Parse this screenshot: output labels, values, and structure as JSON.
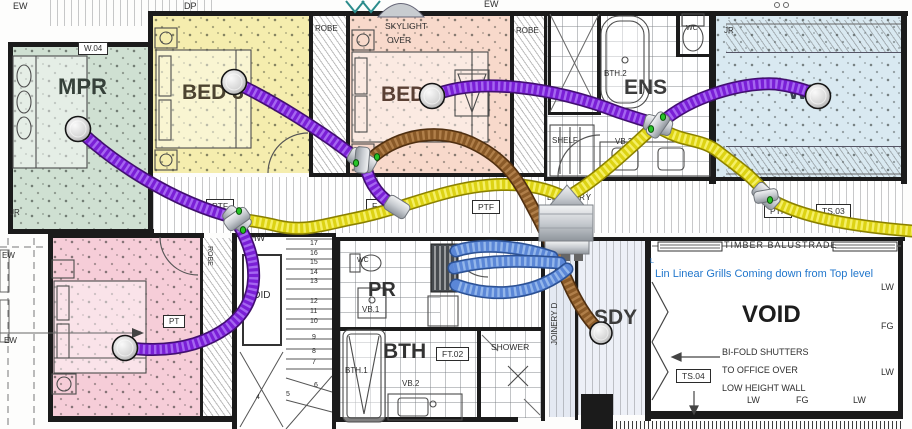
{
  "colors": {
    "purple_core": "#7a1fd6",
    "purple_dark": "#41106e",
    "purple_light": "#a566f0",
    "yellow_core": "#ddd314",
    "yellow_dark": "#8a8000",
    "yellow_light": "#f5ef66",
    "brown_core": "#8a5a28",
    "brown_dark": "#4e2e10",
    "brown_light": "#b07f4a",
    "blue_core": "#5b87d7",
    "blue_dark": "#2c5193",
    "blue_light": "#93b6ea",
    "note_blue": "#2277cc",
    "room_mpr": "#cfe0d2",
    "room_bed3": "#f5edae",
    "room_bed2": "#f8d9cb",
    "room_wir": "#d9e9f1",
    "room_bed4": "#f6cdd8",
    "joinery_floor": "#e4e9f2",
    "sdy_floor": "#edf0f7"
  },
  "note": {
    "text": "Lin Linear Grills Coming down from Top level"
  },
  "labels": [
    {
      "id": "ew-top-left",
      "t": "EW",
      "x": 13,
      "y": 2,
      "s": 9
    },
    {
      "id": "dp-top",
      "t": "DP",
      "x": 184,
      "y": 2,
      "s": 9
    },
    {
      "id": "ew-top-mid",
      "t": "EW",
      "x": 484,
      "y": 0,
      "s": 9
    },
    {
      "id": "w04",
      "t": "W.04",
      "x": 78,
      "y": 42,
      "s": 8,
      "box": true
    },
    {
      "id": "room-mpr",
      "t": "MPR",
      "x": 58,
      "y": 76,
      "s": 22,
      "w": "bold",
      "c": "#36413a"
    },
    {
      "id": "room-bed3",
      "t": "BED 3",
      "x": 182,
      "y": 82,
      "s": 21,
      "w": "bold",
      "c": "#4c4330"
    },
    {
      "id": "room-bed2",
      "t": "BED",
      "x": 381,
      "y": 84,
      "s": 21,
      "w": "bold",
      "c": "#5a4034"
    },
    {
      "id": "room-ens",
      "t": "ENS",
      "x": 624,
      "y": 77,
      "s": 21,
      "w": "bold",
      "c": "#3c3c3c"
    },
    {
      "id": "room-wir",
      "t": "WIR",
      "x": 788,
      "y": 82,
      "s": 21,
      "w": "bold",
      "c": "#3a4450"
    },
    {
      "id": "robe-left",
      "t": "ROBE",
      "x": 315,
      "y": 25,
      "s": 8
    },
    {
      "id": "skylight-line1",
      "t": "SKYLIGHT",
      "x": 385,
      "y": 22,
      "s": 8.5
    },
    {
      "id": "skylight-line2",
      "t": "OVER",
      "x": 387,
      "y": 36,
      "s": 8.5
    },
    {
      "id": "robe-right",
      "t": "ROBE",
      "x": 516,
      "y": 27,
      "s": 8
    },
    {
      "id": "bth2",
      "t": "BTH.2",
      "x": 604,
      "y": 70,
      "s": 8
    },
    {
      "id": "wc-ens",
      "t": "WC",
      "x": 686,
      "y": 25,
      "s": 7
    },
    {
      "id": "jr-wir-top",
      "t": "JR",
      "x": 724,
      "y": 27,
      "s": 8
    },
    {
      "id": "jr-wir-bottom",
      "t": "JR",
      "x": 724,
      "y": 155,
      "s": 8
    },
    {
      "id": "shelf",
      "t": "SHELF",
      "x": 552,
      "y": 137,
      "s": 8
    },
    {
      "id": "vb2-ens",
      "t": "VB.2",
      "x": 615,
      "y": 138,
      "s": 8
    },
    {
      "id": "jr-mpr",
      "t": "JR",
      "x": 10,
      "y": 209,
      "s": 8
    },
    {
      "id": "ew-left-upper",
      "t": "EW",
      "x": 2,
      "y": 252,
      "s": 8
    },
    {
      "id": "ew-left-lower",
      "t": "EW",
      "x": 4,
      "y": 337,
      "s": 8
    },
    {
      "id": "laundry",
      "t": "LAUNDRY",
      "x": 547,
      "y": 194,
      "s": 8,
      "ls": 1
    },
    {
      "id": "ptf-1",
      "t": "PTF",
      "x": 206,
      "y": 199,
      "s": 8.5,
      "box": true
    },
    {
      "id": "ft-1",
      "t": "F",
      "x": 366,
      "y": 199,
      "s": 8.5,
      "box": true
    },
    {
      "id": "ptf-2",
      "t": "PTF",
      "x": 472,
      "y": 200,
      "s": 8.5,
      "box": true
    },
    {
      "id": "ptf-3",
      "t": "PTF",
      "x": 764,
      "y": 204,
      "s": 8.5,
      "box": true
    },
    {
      "id": "ts03",
      "t": "TS.03",
      "x": 816,
      "y": 204,
      "s": 8.5,
      "box": true
    },
    {
      "id": "lhw",
      "t": "LHW",
      "x": 245,
      "y": 234,
      "s": 9
    },
    {
      "id": "void-stair",
      "t": "VOID",
      "x": 246,
      "y": 291,
      "s": 10
    },
    {
      "id": "wc-pr",
      "t": "WC",
      "x": 357,
      "y": 257,
      "s": 7
    },
    {
      "id": "room-pr",
      "t": "PR",
      "x": 368,
      "y": 280,
      "s": 20,
      "w": "bold",
      "c": "#333333"
    },
    {
      "id": "vb1",
      "t": "VB.1",
      "x": 362,
      "y": 306,
      "s": 8
    },
    {
      "id": "room-bth",
      "t": "BTH",
      "x": 383,
      "y": 341,
      "s": 21,
      "w": "bold",
      "c": "#333333"
    },
    {
      "id": "ft02",
      "t": "FT.02",
      "x": 436,
      "y": 347,
      "s": 8.5,
      "box": true
    },
    {
      "id": "bth1",
      "t": "BTH.1",
      "x": 345,
      "y": 367,
      "s": 8
    },
    {
      "id": "vb2-bth",
      "t": "VB.2",
      "x": 402,
      "y": 380,
      "s": 8
    },
    {
      "id": "shower",
      "t": "SHOWER",
      "x": 491,
      "y": 343,
      "s": 8.5
    },
    {
      "id": "joinery",
      "t": "JOINERY D",
      "x": 551,
      "y": 345,
      "s": 8,
      "r": -90
    },
    {
      "id": "room-sdy",
      "t": "SDY",
      "x": 594,
      "y": 307,
      "s": 21,
      "w": "bold",
      "c": "#3c3c3c"
    },
    {
      "id": "room-l",
      "t": "L",
      "x": 465,
      "y": 283,
      "s": 15,
      "w": "bold"
    },
    {
      "id": "timber-balustrade",
      "t": "TIMBER BALUSTRADE",
      "x": 724,
      "y": 241,
      "s": 9,
      "ls": 1
    },
    {
      "id": "room-void",
      "t": "VOID",
      "x": 742,
      "y": 303,
      "s": 24,
      "w": "bold",
      "c": "#1d1d1d"
    },
    {
      "id": "shutters-1",
      "t": "BI-FOLD SHUTTERS",
      "x": 722,
      "y": 348,
      "s": 9
    },
    {
      "id": "shutters-2",
      "t": "TO OFFICE OVER",
      "x": 722,
      "y": 366,
      "s": 9
    },
    {
      "id": "shutters-3",
      "t": "LOW HEIGHT WALL",
      "x": 722,
      "y": 384,
      "s": 9
    },
    {
      "id": "ts04",
      "t": "TS.04",
      "x": 676,
      "y": 369,
      "s": 8.5,
      "box": true
    },
    {
      "id": "lw-right-1",
      "t": "LW",
      "x": 881,
      "y": 283,
      "s": 9
    },
    {
      "id": "fg-right",
      "t": "FG",
      "x": 881,
      "y": 322,
      "s": 9
    },
    {
      "id": "lw-right-2",
      "t": "LW",
      "x": 881,
      "y": 368,
      "s": 9
    },
    {
      "id": "lw-bottom-1",
      "t": "LW",
      "x": 747,
      "y": 396,
      "s": 9
    },
    {
      "id": "fg-bottom",
      "t": "FG",
      "x": 796,
      "y": 396,
      "s": 9
    },
    {
      "id": "lw-bottom-2",
      "t": "LW",
      "x": 853,
      "y": 396,
      "s": 9
    },
    {
      "id": "jr-laundry",
      "t": "JR",
      "x": 507,
      "y": 248,
      "s": 7
    },
    {
      "id": "pt-bed4",
      "t": "PT",
      "x": 163,
      "y": 315,
      "s": 8,
      "box": true
    },
    {
      "id": "robe-bed4",
      "t": "ROBE",
      "x": 213,
      "y": 246,
      "s": 7,
      "r": 90
    },
    {
      "id": "note-leader",
      "t": "L",
      "x": 650,
      "y": 258,
      "s": 7,
      "c": "#2277cc"
    },
    {
      "id": "stair-17",
      "t": "17",
      "x": 310,
      "y": 240,
      "s": 7
    },
    {
      "id": "stair-16",
      "t": "16",
      "x": 310,
      "y": 250,
      "s": 7
    },
    {
      "id": "stair-15",
      "t": "15",
      "x": 310,
      "y": 259,
      "s": 7
    },
    {
      "id": "stair-14",
      "t": "14",
      "x": 310,
      "y": 269,
      "s": 7
    },
    {
      "id": "stair-13",
      "t": "13",
      "x": 310,
      "y": 278,
      "s": 7
    },
    {
      "id": "stair-12",
      "t": "12",
      "x": 310,
      "y": 298,
      "s": 7
    },
    {
      "id": "stair-11",
      "t": "11",
      "x": 310,
      "y": 308,
      "s": 7
    },
    {
      "id": "stair-10",
      "t": "10",
      "x": 310,
      "y": 318,
      "s": 7
    },
    {
      "id": "stair-9",
      "t": "9",
      "x": 312,
      "y": 334,
      "s": 7
    },
    {
      "id": "stair-8",
      "t": "8",
      "x": 312,
      "y": 348,
      "s": 7
    },
    {
      "id": "stair-7",
      "t": "7",
      "x": 312,
      "y": 359,
      "s": 7
    },
    {
      "id": "stair-6",
      "t": "6",
      "x": 314,
      "y": 382,
      "s": 7
    },
    {
      "id": "stair-5",
      "t": "5",
      "x": 286,
      "y": 391,
      "s": 7
    },
    {
      "id": "stair-4",
      "t": "4",
      "x": 256,
      "y": 394,
      "s": 7
    }
  ]
}
